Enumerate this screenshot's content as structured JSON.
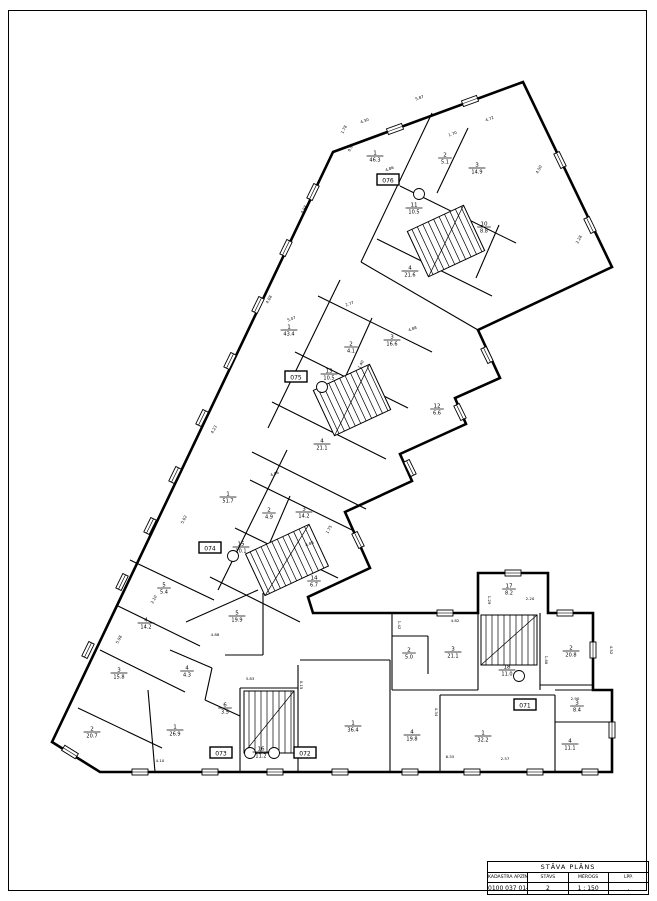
{
  "title_block": {
    "title": "STĀVA PLĀNS",
    "headers": [
      "KADASTRA APZĪMĒJUMS",
      "STĀVS",
      "MĒROGS",
      "LPP."
    ],
    "values": [
      "0100 037 0144 001",
      "2",
      "1 : 150",
      "."
    ]
  },
  "plan": {
    "drawing_type": "floor-plan",
    "floor": "2",
    "scale": "1 : 150",
    "rooms": [
      {
        "n": "1",
        "a": "46.3",
        "x": 375,
        "y": 156
      },
      {
        "n": "2",
        "a": "5.1",
        "x": 445,
        "y": 158
      },
      {
        "n": "3",
        "a": "14.9",
        "x": 477,
        "y": 168
      },
      {
        "n": "11",
        "a": "10.5",
        "x": 414,
        "y": 208
      },
      {
        "n": "10",
        "a": "8.8",
        "x": 484,
        "y": 227
      },
      {
        "n": "4",
        "a": "21.6",
        "x": 410,
        "y": 271
      },
      {
        "n": "1",
        "a": "43.4",
        "x": 289,
        "y": 330
      },
      {
        "n": "2",
        "a": "4.1",
        "x": 351,
        "y": 347
      },
      {
        "n": "3",
        "a": "16.6",
        "x": 392,
        "y": 340
      },
      {
        "n": "13",
        "a": "10.5",
        "x": 329,
        "y": 374
      },
      {
        "n": "12",
        "a": "6.6",
        "x": 437,
        "y": 409
      },
      {
        "n": "4",
        "a": "21.1",
        "x": 322,
        "y": 444
      },
      {
        "n": "1",
        "a": "51.7",
        "x": 228,
        "y": 497
      },
      {
        "n": "2",
        "a": "4.9",
        "x": 269,
        "y": 513
      },
      {
        "n": "3",
        "a": "14.2",
        "x": 304,
        "y": 512
      },
      {
        "n": "15",
        "a": "10.1",
        "x": 241,
        "y": 547
      },
      {
        "n": "14",
        "a": "6.7",
        "x": 314,
        "y": 581
      },
      {
        "n": "5",
        "a": "5.4",
        "x": 164,
        "y": 588
      },
      {
        "n": "4",
        "a": "14.2",
        "x": 146,
        "y": 623
      },
      {
        "n": "3",
        "a": "15.8",
        "x": 119,
        "y": 673
      },
      {
        "n": "2",
        "a": "20.7",
        "x": 92,
        "y": 732
      },
      {
        "n": "1",
        "a": "26.9",
        "x": 175,
        "y": 730
      },
      {
        "n": "4",
        "a": "4.3",
        "x": 187,
        "y": 671
      },
      {
        "n": "6",
        "a": "3.5",
        "x": 225,
        "y": 708
      },
      {
        "n": "5",
        "a": "19.9",
        "x": 237,
        "y": 616
      },
      {
        "n": "16",
        "a": "11.2",
        "x": 261,
        "y": 752
      },
      {
        "n": "17",
        "a": "8.2",
        "x": 509,
        "y": 589
      },
      {
        "n": "3",
        "a": "21.1",
        "x": 453,
        "y": 652
      },
      {
        "n": "2",
        "a": "20.8",
        "x": 571,
        "y": 651
      },
      {
        "n": "18",
        "a": "11.0",
        "x": 507,
        "y": 670
      },
      {
        "n": "2",
        "a": "5.0",
        "x": 409,
        "y": 653
      },
      {
        "n": "1",
        "a": "36.4",
        "x": 353,
        "y": 726
      },
      {
        "n": "4",
        "a": "19.8",
        "x": 412,
        "y": 735
      },
      {
        "n": "1",
        "a": "32.2",
        "x": 483,
        "y": 736
      },
      {
        "n": "3",
        "a": "8.4",
        "x": 577,
        "y": 706
      },
      {
        "n": "4",
        "a": "11.1",
        "x": 570,
        "y": 744
      }
    ],
    "unit_tags": [
      {
        "label": "076",
        "x": 388,
        "y": 180
      },
      {
        "label": "075",
        "x": 296,
        "y": 377
      },
      {
        "label": "074",
        "x": 210,
        "y": 548
      },
      {
        "label": "073",
        "x": 221,
        "y": 753
      },
      {
        "label": "072",
        "x": 305,
        "y": 753
      },
      {
        "label": "071",
        "x": 525,
        "y": 705
      }
    ],
    "dimensions": [
      {
        "t": "5.87",
        "x": 420,
        "y": 99,
        "r": -20
      },
      {
        "t": "4.30",
        "x": 365,
        "y": 122,
        "r": -20
      },
      {
        "t": "4.72",
        "x": 490,
        "y": 120,
        "r": -20
      },
      {
        "t": "1.78",
        "x": 345,
        "y": 130,
        "r": -63
      },
      {
        "t": "0.91",
        "x": 352,
        "y": 148,
        "r": -63
      },
      {
        "t": "4.86",
        "x": 390,
        "y": 170,
        "r": -20
      },
      {
        "t": "1.70",
        "x": 453,
        "y": 135,
        "r": -20
      },
      {
        "t": "4.50",
        "x": 540,
        "y": 170,
        "r": -63
      },
      {
        "t": "2.28",
        "x": 580,
        "y": 240,
        "r": -63
      },
      {
        "t": "4.98",
        "x": 305,
        "y": 210,
        "r": -63
      },
      {
        "t": "4.88",
        "x": 270,
        "y": 300,
        "r": -63
      },
      {
        "t": "5.07",
        "x": 292,
        "y": 320,
        "r": -20
      },
      {
        "t": "2.77",
        "x": 350,
        "y": 305,
        "r": -20
      },
      {
        "t": "4.88",
        "x": 413,
        "y": 330,
        "r": -20
      },
      {
        "t": "1.40",
        "x": 362,
        "y": 365,
        "r": -63
      },
      {
        "t": "4.23",
        "x": 215,
        "y": 430,
        "r": -63
      },
      {
        "t": "4.06",
        "x": 275,
        "y": 475,
        "r": -20
      },
      {
        "t": "5.02",
        "x": 185,
        "y": 520,
        "r": -63
      },
      {
        "t": "4.88",
        "x": 310,
        "y": 545,
        "r": -20
      },
      {
        "t": "1.75",
        "x": 330,
        "y": 530,
        "r": -63
      },
      {
        "t": "5.98",
        "x": 120,
        "y": 640,
        "r": -63
      },
      {
        "t": "2.10",
        "x": 155,
        "y": 600,
        "r": -63
      },
      {
        "t": "4.88",
        "x": 215,
        "y": 636,
        "r": 0
      },
      {
        "t": "1.29",
        "x": 488,
        "y": 600,
        "r": 90
      },
      {
        "t": "2.20",
        "x": 530,
        "y": 600,
        "r": 0
      },
      {
        "t": "1.42",
        "x": 398,
        "y": 625,
        "r": 90
      },
      {
        "t": "4.82",
        "x": 455,
        "y": 622,
        "r": 0
      },
      {
        "t": "4.52",
        "x": 610,
        "y": 650,
        "r": 90
      },
      {
        "t": "6.55",
        "x": 450,
        "y": 758,
        "r": 0
      },
      {
        "t": "4.10",
        "x": 160,
        "y": 762,
        "r": 0
      },
      {
        "t": "3.83",
        "x": 250,
        "y": 680,
        "r": 0
      },
      {
        "t": "2.57",
        "x": 505,
        "y": 760,
        "r": 0
      },
      {
        "t": "4.34",
        "x": 435,
        "y": 712,
        "r": 90
      },
      {
        "t": "1.88",
        "x": 545,
        "y": 660,
        "r": 90
      },
      {
        "t": "2.90",
        "x": 575,
        "y": 700,
        "r": 0
      },
      {
        "t": "0.15",
        "x": 300,
        "y": 685,
        "r": 90
      }
    ]
  }
}
